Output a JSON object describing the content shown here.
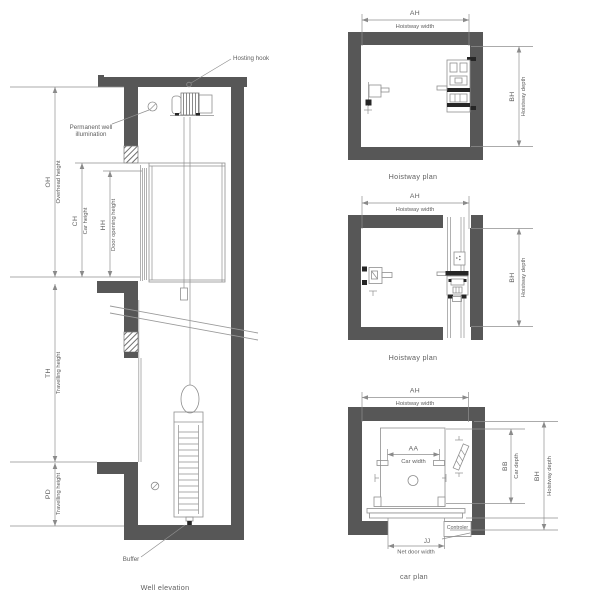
{
  "colors": {
    "wall": "#575757",
    "line": "#9a9a9a",
    "text": "#5f5f5f"
  },
  "elevation": {
    "caption": "Well elevation",
    "labels": {
      "hoisting_hook": "Hosting hook",
      "illumination_line1": "Permanent well",
      "illumination_line2": "illumination",
      "buffer": "Buffer"
    },
    "dims": {
      "oh": {
        "code": "OH",
        "name": "Overhead height"
      },
      "ch": {
        "code": "CH",
        "name": "Car height"
      },
      "hh": {
        "code": "HH",
        "name": "Door opening height"
      },
      "th": {
        "code": "TH",
        "name": "Travelling height"
      },
      "pd": {
        "code": "PD",
        "name": "Travelling height"
      }
    }
  },
  "plan_top": {
    "caption": "Hoistway plan",
    "dims": {
      "width": {
        "code": "AH",
        "name": "Hoistway width"
      },
      "depth": {
        "code": "BH",
        "name": "Hoistway depth"
      }
    }
  },
  "plan_middle": {
    "caption": "Hoistway plan",
    "dims": {
      "width": {
        "code": "AH",
        "name": "Hoistway width"
      },
      "depth": {
        "code": "BH",
        "name": "Hoistway depth"
      }
    }
  },
  "plan_car": {
    "caption": "car plan",
    "labels": {
      "controller": "Controler"
    },
    "dims": {
      "hoistway_width": {
        "code": "AH",
        "name": "Hoistway width"
      },
      "car_width": {
        "code": "AA",
        "name": "Car width"
      },
      "car_depth": {
        "code": "BB",
        "name": "Car depth"
      },
      "hoistway_depth": {
        "code": "BH",
        "name": "Hoistway depth"
      },
      "door_width": {
        "code": "JJ",
        "name": "Net door width"
      }
    }
  }
}
